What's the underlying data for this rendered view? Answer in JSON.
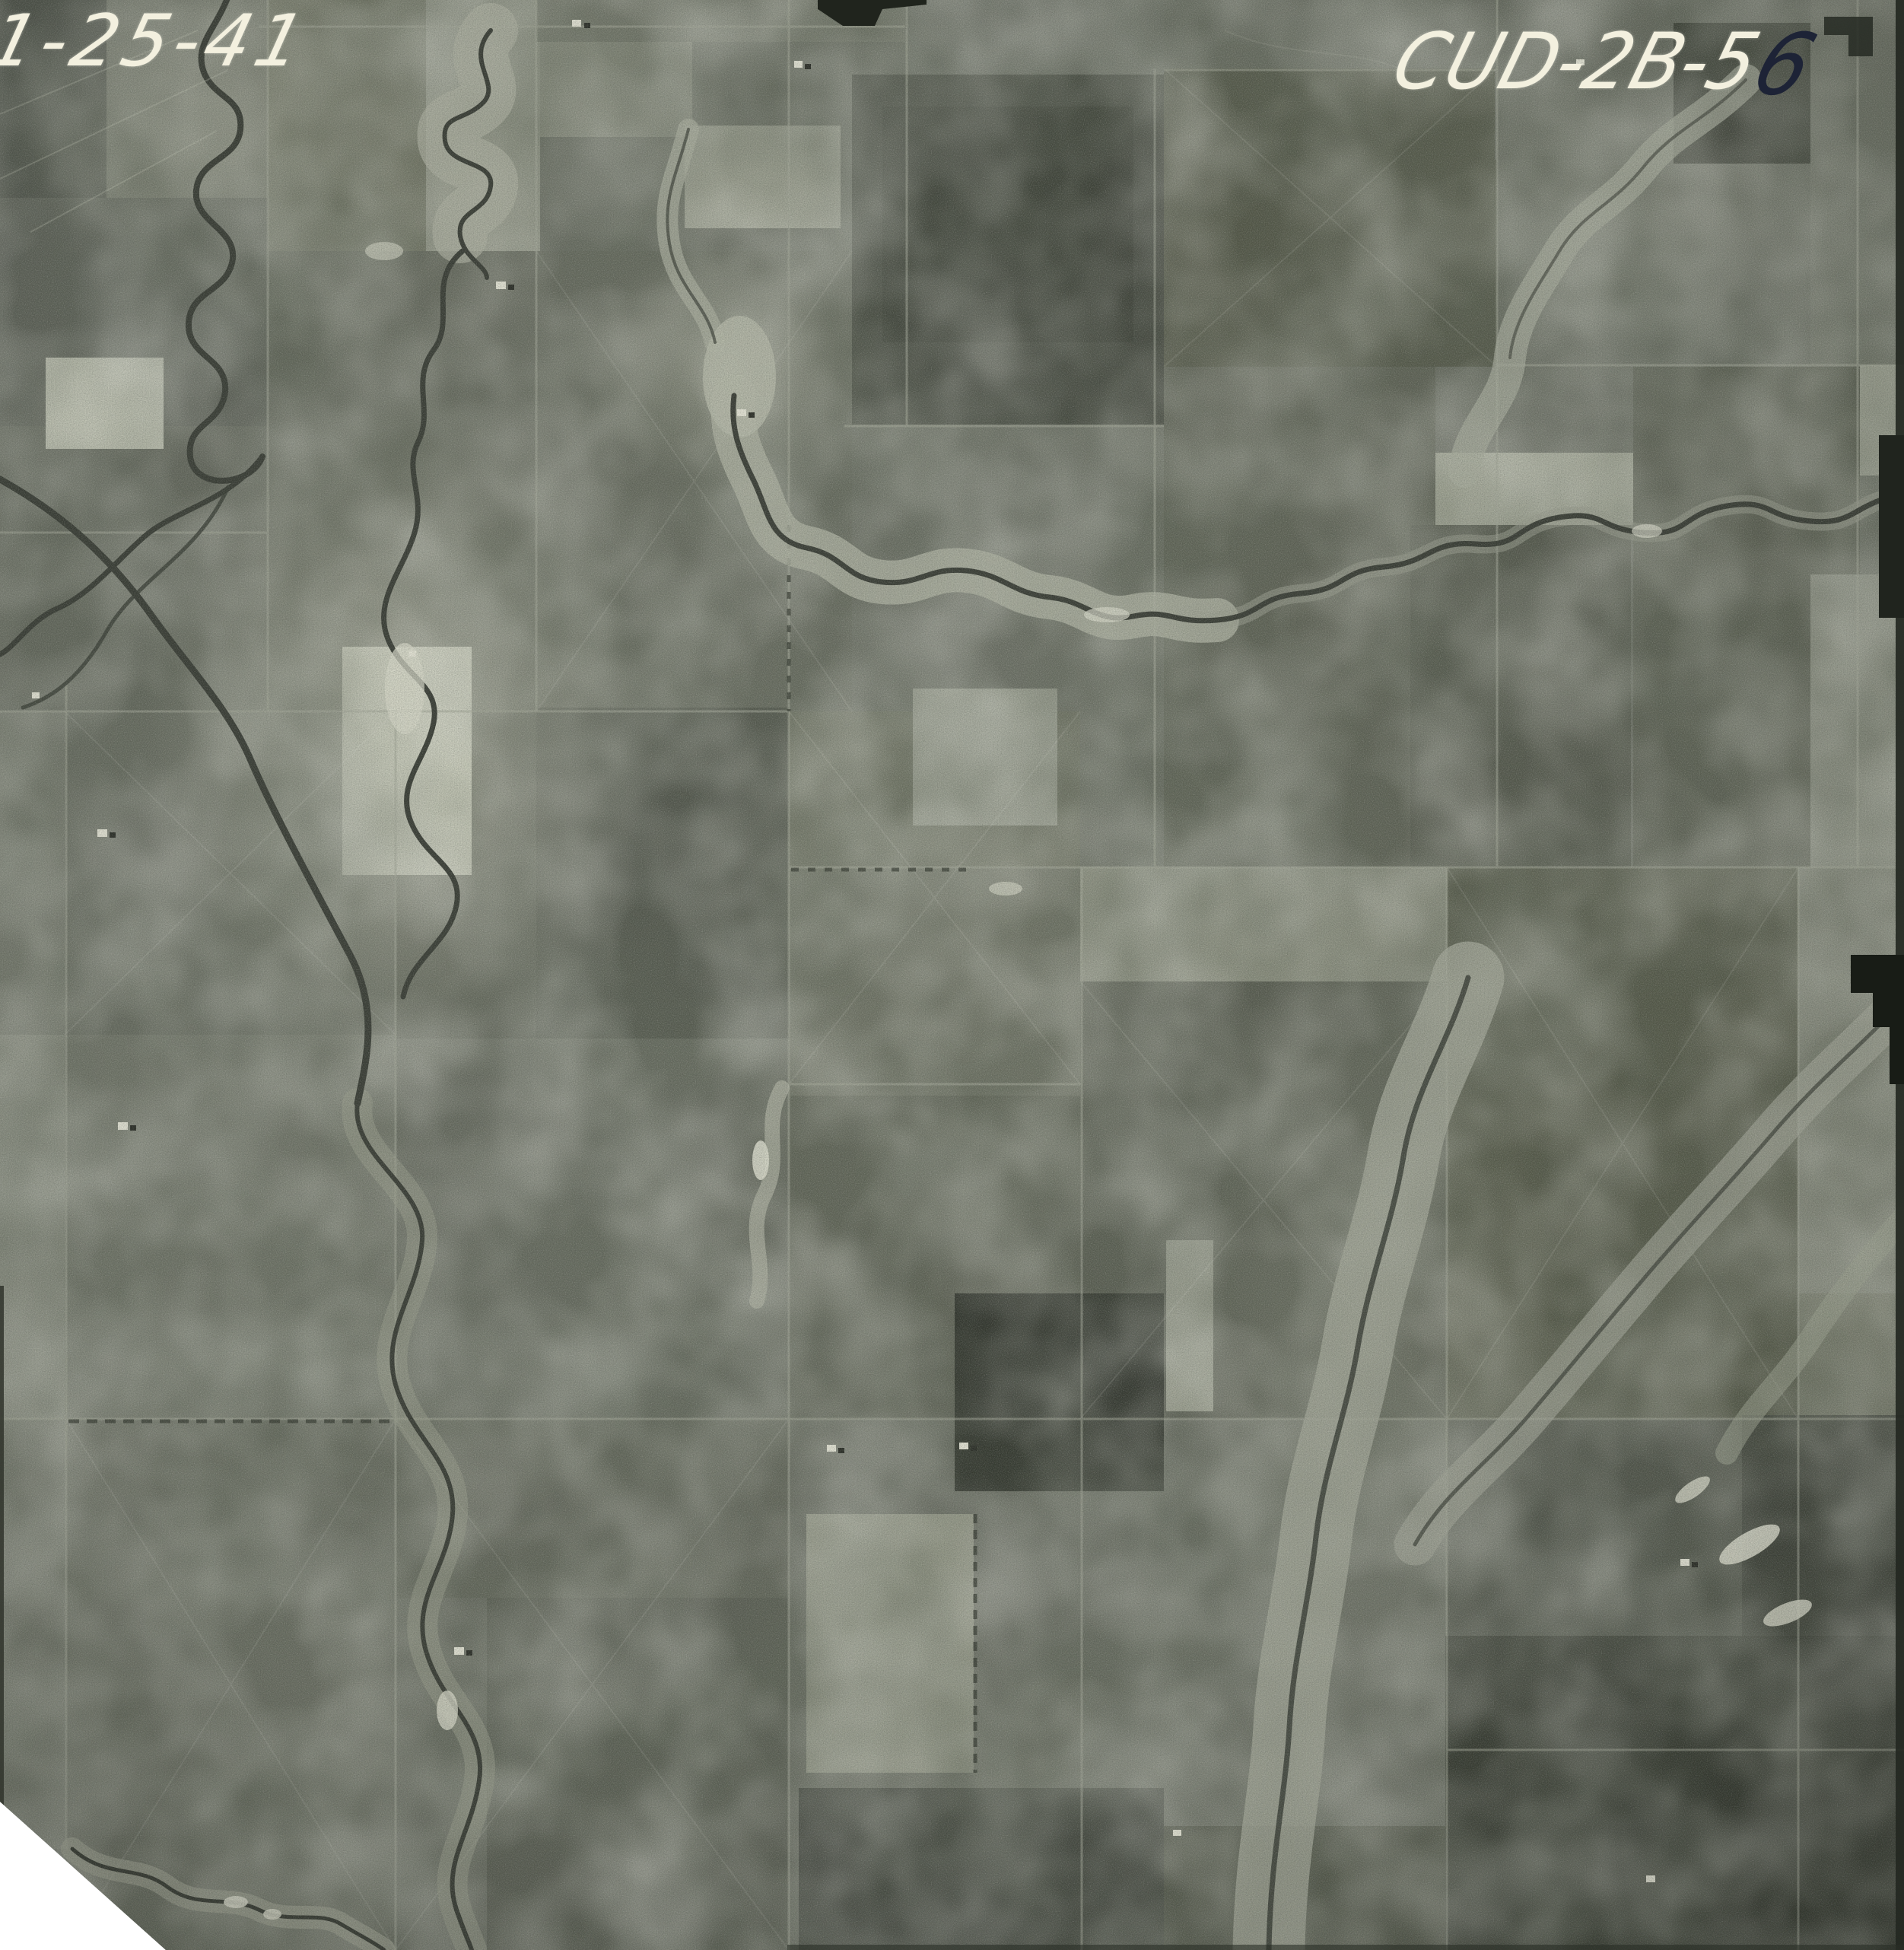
{
  "photo": {
    "description": "Black-and-white aerial survey photograph of sectioned farmland with meandering creeks, dated 1941",
    "date_annotation": "1-25-41",
    "photo_id_white": "CUD-2B-5",
    "photo_id_dark_digit": "6",
    "ink_white_color": "#f3f0df",
    "ink_dark_color": "#1d2336",
    "film_base_tone": "#6e7267",
    "cut_corner": "bottom-left"
  }
}
